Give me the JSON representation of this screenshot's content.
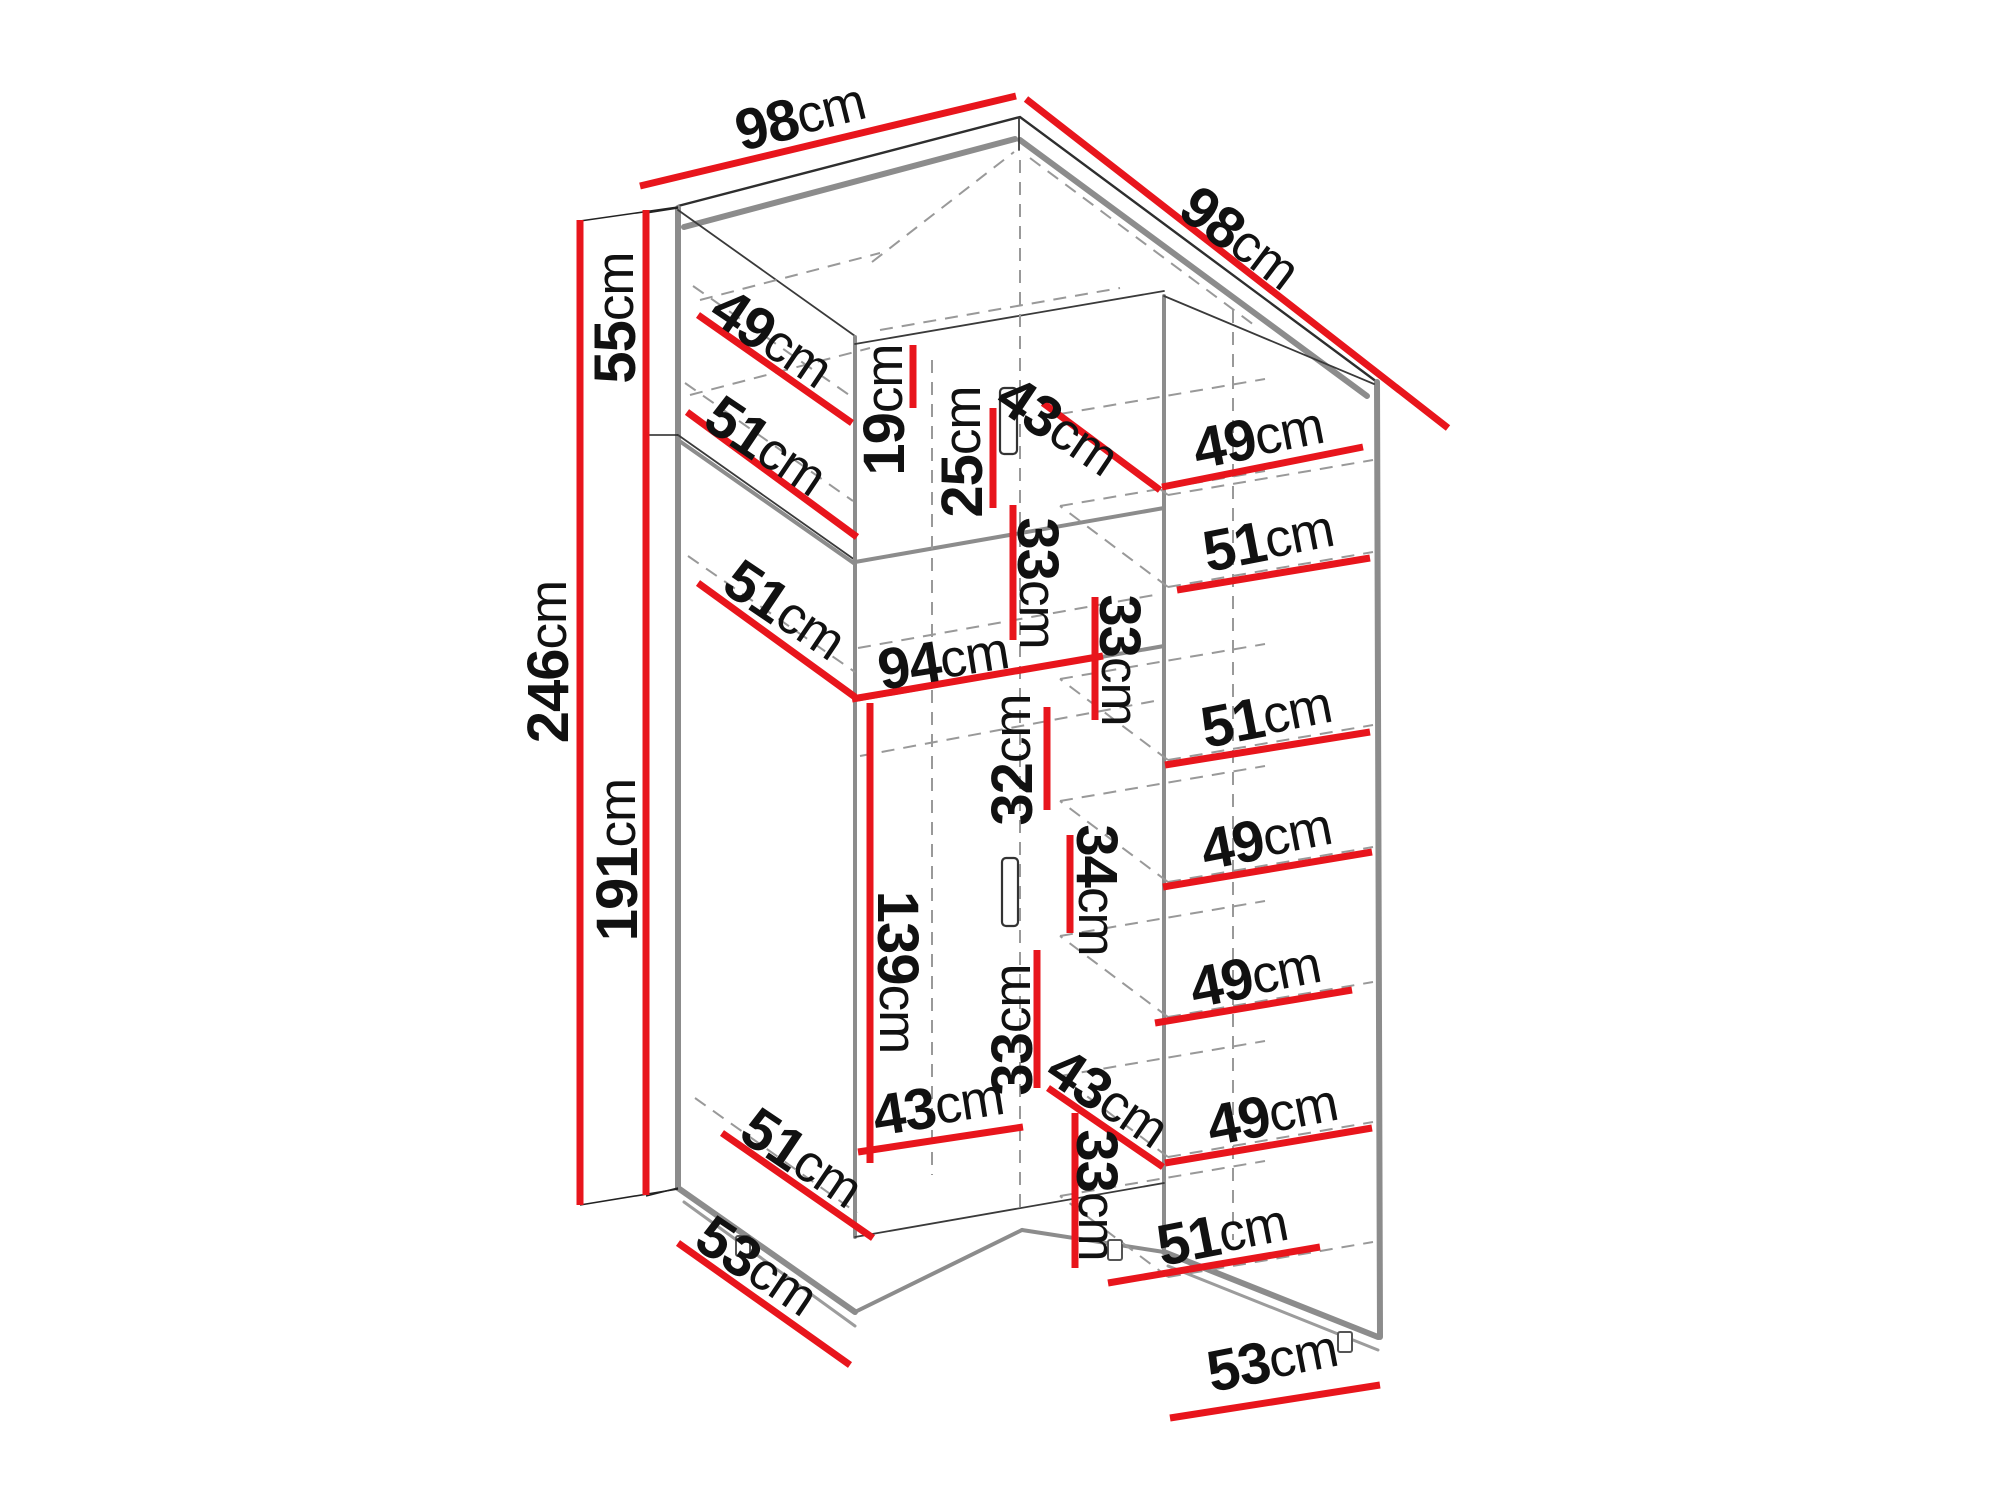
{
  "diagram": {
    "type": "furniture-dimension-diagram",
    "subject": "corner wardrobe isometric drawing with dimensions",
    "unit": "cm",
    "colors": {
      "background": "#ffffff",
      "dimension_line": "#e8151c",
      "outline": "#2e2e2e",
      "panel_edge": "#8c8c8c",
      "hidden_edge": "#999999",
      "label": "#111111"
    },
    "labels": [
      {
        "name": "top-width-left",
        "value": "98",
        "unit": "cm",
        "x": 800,
        "y": 116,
        "rotate": -14
      },
      {
        "name": "top-width-right",
        "value": "98",
        "unit": "cm",
        "x": 1240,
        "y": 238,
        "rotate": 37
      },
      {
        "name": "upper-section-height",
        "value": "55",
        "unit": "cm",
        "x": 615,
        "y": 318,
        "rotate": -90
      },
      {
        "name": "total-height",
        "value": "246",
        "unit": "cm",
        "x": 548,
        "y": 662,
        "rotate": -90
      },
      {
        "name": "lower-section-height",
        "value": "191",
        "unit": "cm",
        "x": 617,
        "y": 860,
        "rotate": -90
      },
      {
        "name": "upper-left-shelf-depth",
        "value": "49",
        "unit": "cm",
        "x": 772,
        "y": 338,
        "rotate": 34
      },
      {
        "name": "upper-left-bottom-depth",
        "value": "51",
        "unit": "cm",
        "x": 766,
        "y": 446,
        "rotate": 34
      },
      {
        "name": "corner-top-gap-height",
        "value": "19",
        "unit": "cm",
        "x": 884,
        "y": 410,
        "rotate": -90
      },
      {
        "name": "corner-upper-door-height",
        "value": "25",
        "unit": "cm",
        "x": 962,
        "y": 452,
        "rotate": -90
      },
      {
        "name": "corner-top-width",
        "value": "43",
        "unit": "cm",
        "x": 1058,
        "y": 426,
        "rotate": 34
      },
      {
        "name": "right-top-shelf-depth",
        "value": "49",
        "unit": "cm",
        "x": 1258,
        "y": 437,
        "rotate": -11
      },
      {
        "name": "right-shelf-1",
        "value": "51",
        "unit": "cm",
        "x": 1268,
        "y": 540,
        "rotate": -11
      },
      {
        "name": "mid-left-shelf-depth",
        "value": "51",
        "unit": "cm",
        "x": 785,
        "y": 610,
        "rotate": 34
      },
      {
        "name": "corner-opening-width",
        "value": "94",
        "unit": "cm",
        "x": 943,
        "y": 660,
        "rotate": -9
      },
      {
        "name": "corner-shelf-gap-left",
        "value": "33",
        "unit": "cm",
        "x": 1038,
        "y": 583,
        "rotate": 90
      },
      {
        "name": "corner-shelf-gap-right",
        "value": "33",
        "unit": "cm",
        "x": 1120,
        "y": 660,
        "rotate": 90
      },
      {
        "name": "corner-gap-height",
        "value": "32",
        "unit": "cm",
        "x": 1012,
        "y": 760,
        "rotate": -90
      },
      {
        "name": "right-shelf-2",
        "value": "51",
        "unit": "cm",
        "x": 1266,
        "y": 716,
        "rotate": -11
      },
      {
        "name": "right-shelf-3",
        "value": "49",
        "unit": "cm",
        "x": 1266,
        "y": 838,
        "rotate": -11
      },
      {
        "name": "corner-mid-gap",
        "value": "34",
        "unit": "cm",
        "x": 1097,
        "y": 890,
        "rotate": 90
      },
      {
        "name": "lower-door-height",
        "value": "139",
        "unit": "cm",
        "x": 898,
        "y": 972,
        "rotate": 90
      },
      {
        "name": "corner-lower-gap-left",
        "value": "33",
        "unit": "cm",
        "x": 1012,
        "y": 1030,
        "rotate": -90
      },
      {
        "name": "lower-left-width",
        "value": "43",
        "unit": "cm",
        "x": 938,
        "y": 1106,
        "rotate": -9
      },
      {
        "name": "corner-lower-width",
        "value": "43",
        "unit": "cm",
        "x": 1108,
        "y": 1098,
        "rotate": 34
      },
      {
        "name": "right-shelf-4",
        "value": "49",
        "unit": "cm",
        "x": 1255,
        "y": 976,
        "rotate": -11
      },
      {
        "name": "right-shelf-5",
        "value": "49",
        "unit": "cm",
        "x": 1272,
        "y": 1114,
        "rotate": -11
      },
      {
        "name": "corner-lower-gap-right",
        "value": "33",
        "unit": "cm",
        "x": 1097,
        "y": 1195,
        "rotate": 90
      },
      {
        "name": "right-shelf-6",
        "value": "51",
        "unit": "cm",
        "x": 1222,
        "y": 1234,
        "rotate": -11
      },
      {
        "name": "lower-left-shelf-depth",
        "value": "51",
        "unit": "cm",
        "x": 802,
        "y": 1158,
        "rotate": 34
      },
      {
        "name": "left-base-depth",
        "value": "53",
        "unit": "cm",
        "x": 757,
        "y": 1266,
        "rotate": 34
      },
      {
        "name": "right-base-depth",
        "value": "53",
        "unit": "cm",
        "x": 1272,
        "y": 1360,
        "rotate": -11
      }
    ]
  }
}
